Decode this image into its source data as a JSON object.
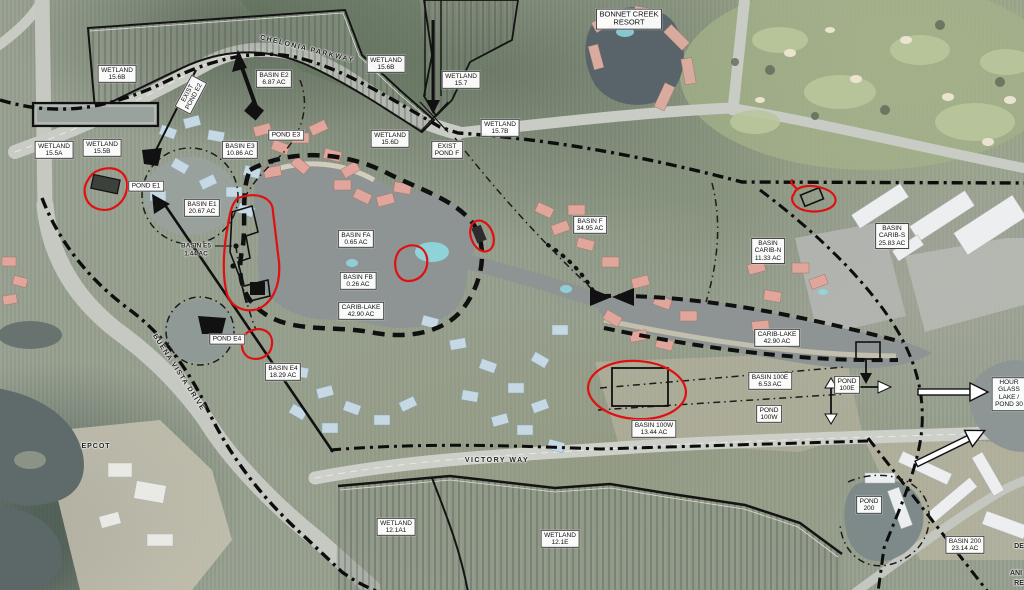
{
  "map": {
    "colors": {
      "annotation_red": "#e01010",
      "boundary_black": "#101010",
      "label_box_bg": "#ffffff",
      "water_gray": "#8d9493"
    },
    "labels": [
      {
        "id": "wetland-15-6b-west",
        "lines": [
          "WETLAND",
          "15.6B"
        ],
        "x": 117,
        "y": 74,
        "boxed": true
      },
      {
        "id": "wetland-15-5a",
        "lines": [
          "WETLAND",
          "15.5A"
        ],
        "x": 54,
        "y": 150,
        "boxed": true
      },
      {
        "id": "wetland-15-5b",
        "lines": [
          "WETLAND",
          "15.5B"
        ],
        "x": 102,
        "y": 148,
        "boxed": true
      },
      {
        "id": "exist-pond-e2",
        "lines": [
          "EXIST",
          "POND E2"
        ],
        "x": 191,
        "y": 95,
        "boxed": true,
        "rotate": -62
      },
      {
        "id": "chelonia-parkway",
        "lines": [
          "CHELONIA PARKWAY"
        ],
        "x": 307,
        "y": 50,
        "boxed": false,
        "rotate": 14,
        "size": 7,
        "spacing": 1.5
      },
      {
        "id": "basin-e2",
        "lines": [
          "BASIN E2",
          "6.87 AC"
        ],
        "x": 274,
        "y": 79,
        "boxed": true
      },
      {
        "id": "wetland-15-6b-north",
        "lines": [
          "WETLAND",
          "15.6B"
        ],
        "x": 386,
        "y": 64,
        "boxed": true
      },
      {
        "id": "wetland-15-7",
        "lines": [
          "WETLAND",
          "15.7"
        ],
        "x": 461,
        "y": 80,
        "boxed": true
      },
      {
        "id": "bonnet-creek-resort",
        "lines": [
          "BONNET CREEK",
          "RESORT"
        ],
        "x": 629,
        "y": 19,
        "boxed": true,
        "size": 7.5
      },
      {
        "id": "wetland-15-6d",
        "lines": [
          "WETLAND",
          "15.6D"
        ],
        "x": 390,
        "y": 139,
        "boxed": true
      },
      {
        "id": "exist-pond-f",
        "lines": [
          "EXIST",
          "POND F"
        ],
        "x": 447,
        "y": 150,
        "boxed": true
      },
      {
        "id": "wetland-15-7b",
        "lines": [
          "WETLAND",
          "15.7B"
        ],
        "x": 500,
        "y": 128,
        "boxed": true
      },
      {
        "id": "pond-e1",
        "lines": [
          "POND E1"
        ],
        "x": 146,
        "y": 186,
        "boxed": true
      },
      {
        "id": "pond-e3",
        "lines": [
          "POND E3"
        ],
        "x": 286,
        "y": 135,
        "boxed": true
      },
      {
        "id": "basin-e3",
        "lines": [
          "BASIN E3",
          "10.86 AC"
        ],
        "x": 240,
        "y": 150,
        "boxed": true
      },
      {
        "id": "basin-e1",
        "lines": [
          "BASIN E1",
          "20.67 AC"
        ],
        "x": 202,
        "y": 208,
        "boxed": true
      },
      {
        "id": "basin-e5",
        "lines": [
          "BASIN E5",
          "1.44 AC"
        ],
        "x": 196,
        "y": 250,
        "boxed": false,
        "size": 6.5
      },
      {
        "id": "basin-fa",
        "lines": [
          "BASIN FA",
          "0.65 AC"
        ],
        "x": 356,
        "y": 239,
        "boxed": true
      },
      {
        "id": "basin-fb",
        "lines": [
          "BASIN FB",
          "0.26 AC"
        ],
        "x": 358,
        "y": 281,
        "boxed": true
      },
      {
        "id": "carib-lake-west",
        "lines": [
          "CARIB-LAKE",
          "42.90 AC"
        ],
        "x": 361,
        "y": 311,
        "boxed": true
      },
      {
        "id": "basin-f",
        "lines": [
          "BASIN F",
          "34.95 AC"
        ],
        "x": 590,
        "y": 225,
        "boxed": true
      },
      {
        "id": "basin-carib-n",
        "lines": [
          "BASIN",
          "CARIB-N",
          "11.33 AC"
        ],
        "x": 768,
        "y": 251,
        "boxed": true
      },
      {
        "id": "basin-carib-s",
        "lines": [
          "BASIN",
          "CARIB-S",
          "25.83 AC"
        ],
        "x": 892,
        "y": 236,
        "boxed": true
      },
      {
        "id": "carib-lake-east",
        "lines": [
          "CARIB-LAKE",
          "42.90 AC"
        ],
        "x": 777,
        "y": 338,
        "boxed": true
      },
      {
        "id": "basin-100e",
        "lines": [
          "BASIN 100E",
          "6.53 AC"
        ],
        "x": 770,
        "y": 381,
        "boxed": true
      },
      {
        "id": "pond-100e",
        "lines": [
          "POND",
          "100E"
        ],
        "x": 847,
        "y": 385,
        "boxed": true
      },
      {
        "id": "pond-100w",
        "lines": [
          "POND",
          "100W"
        ],
        "x": 769,
        "y": 414,
        "boxed": true
      },
      {
        "id": "basin-100w",
        "lines": [
          "BASIN 100W",
          "13.44 AC"
        ],
        "x": 654,
        "y": 429,
        "boxed": true
      },
      {
        "id": "pond-e4",
        "lines": [
          "POND E4"
        ],
        "x": 227,
        "y": 339,
        "boxed": true
      },
      {
        "id": "basin-e4",
        "lines": [
          "BASIN E4",
          "18.29 AC"
        ],
        "x": 283,
        "y": 372,
        "boxed": true
      },
      {
        "id": "buena-vista-drive",
        "lines": [
          "BUENA VISTA DRIVE"
        ],
        "x": 178,
        "y": 373,
        "boxed": false,
        "rotate": 57,
        "size": 7,
        "spacing": 1.2
      },
      {
        "id": "victory-way",
        "lines": [
          "VICTORY WAY"
        ],
        "x": 497,
        "y": 461,
        "boxed": false,
        "size": 7,
        "spacing": 1.5
      },
      {
        "id": "epcot",
        "lines": [
          "EPCOT"
        ],
        "x": 96,
        "y": 447,
        "boxed": false,
        "size": 7,
        "spacing": 1
      },
      {
        "id": "wetland-12-1a1",
        "lines": [
          "WETLAND",
          "12.1A1"
        ],
        "x": 396,
        "y": 527,
        "boxed": true
      },
      {
        "id": "wetland-12-1e",
        "lines": [
          "WETLAND",
          "12.1E"
        ],
        "x": 560,
        "y": 539,
        "boxed": true
      },
      {
        "id": "pond-200",
        "lines": [
          "POND",
          "200"
        ],
        "x": 869,
        "y": 505,
        "boxed": true
      },
      {
        "id": "basin-200",
        "lines": [
          "BASIN 200",
          "23.14 AC"
        ],
        "x": 965,
        "y": 545,
        "boxed": true
      },
      {
        "id": "hour-glass-lake",
        "lines": [
          "HOUR",
          "GLASS",
          "LAKE /",
          "POND 30"
        ],
        "x": 1009,
        "y": 394,
        "boxed": true
      },
      {
        "id": "edge-text-de",
        "lines": [
          "DE"
        ],
        "x": 1019,
        "y": 547,
        "boxed": false,
        "size": 7
      },
      {
        "id": "edge-text-ani",
        "lines": [
          "ANI"
        ],
        "x": 1016,
        "y": 574,
        "boxed": false,
        "size": 7
      },
      {
        "id": "edge-text-re",
        "lines": [
          "RE"
        ],
        "x": 1019,
        "y": 584,
        "boxed": false,
        "size": 7
      }
    ]
  }
}
